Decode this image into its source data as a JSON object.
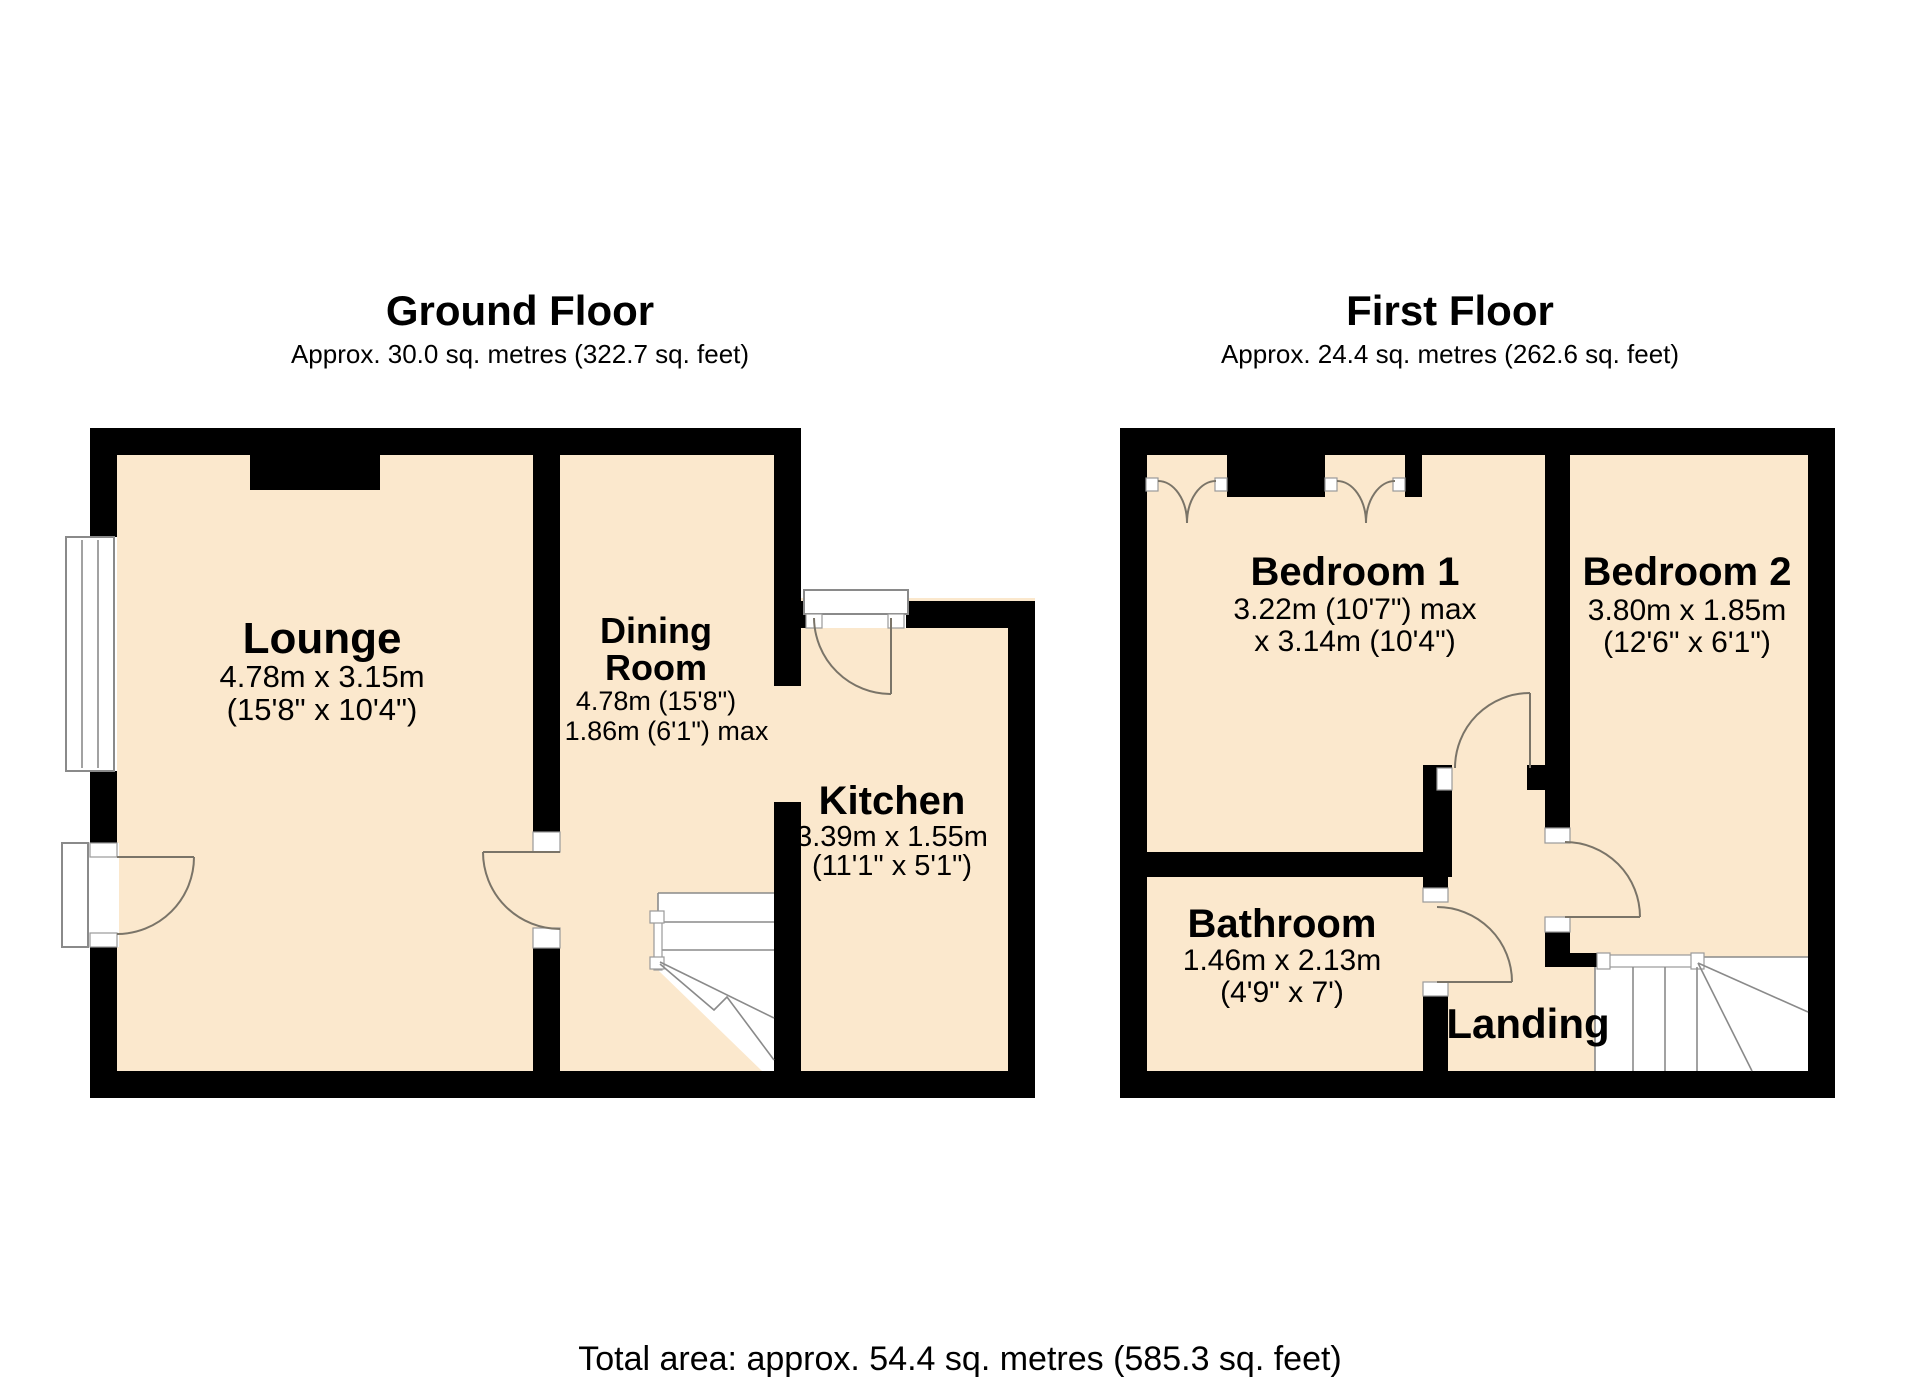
{
  "colors": {
    "room_fill": "#fbe8cd",
    "wall": "#000000",
    "detail_line": "#7a7468",
    "frame_line": "#8a8a8a",
    "background": "#ffffff"
  },
  "ground_floor": {
    "title": "Ground Floor",
    "subtitle": "Approx. 30.0 sq. metres (322.7 sq. feet)",
    "rooms": {
      "lounge": {
        "name": "Lounge",
        "dim_metric": "4.78m x 3.15m",
        "dim_imperial": "(15'8\" x 10'4\")"
      },
      "dining_room": {
        "name_line1": "Dining",
        "name_line2": "Room",
        "dim_metric": "4.78m (15'8\")",
        "dim_imperial": "x 1.86m (6'1\") max"
      },
      "kitchen": {
        "name": "Kitchen",
        "dim_metric": "3.39m x 1.55m",
        "dim_imperial": "(11'1\" x 5'1\")"
      }
    }
  },
  "first_floor": {
    "title": "First Floor",
    "subtitle": "Approx. 24.4 sq. metres (262.6 sq. feet)",
    "rooms": {
      "bedroom1": {
        "name": "Bedroom 1",
        "dim_metric": "3.22m (10'7\") max",
        "dim_imperial": "x 3.14m (10'4\")"
      },
      "bedroom2": {
        "name": "Bedroom 2",
        "dim_metric": "3.80m x 1.85m",
        "dim_imperial": "(12'6\" x 6'1\")"
      },
      "bathroom": {
        "name": "Bathroom",
        "dim_metric": "1.46m x 2.13m",
        "dim_imperial": "(4'9\" x 7')"
      },
      "landing": {
        "name": "Landing"
      }
    }
  },
  "footer": {
    "total_area": "Total area: approx. 54.4 sq. metres (585.3 sq. feet)"
  }
}
